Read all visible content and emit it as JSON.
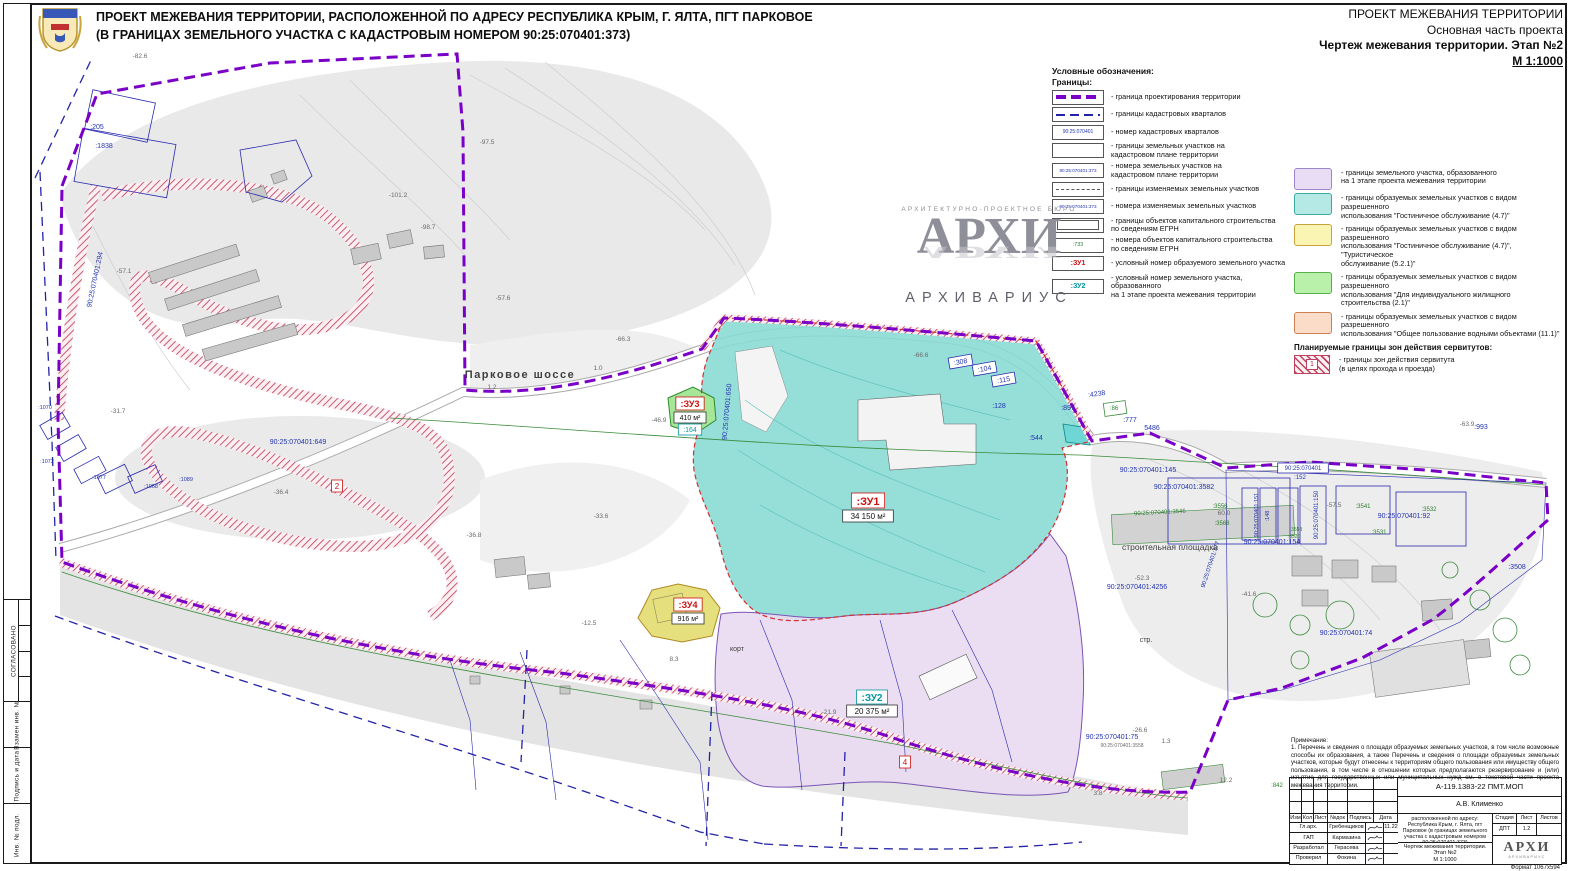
{
  "header_left": {
    "line1": "ПРОЕКТ МЕЖЕВАНИЯ ТЕРРИТОРИИ, РАСПОЛОЖЕННОЙ ПО АДРЕСУ РЕСПУБЛИКА КРЫМ, Г. ЯЛТА, ПГТ ПАРКОВОЕ",
    "line2": "(В ГРАНИЦАХ ЗЕМЕЛЬНОГО УЧАСТКА С КАДАСТРОВЫМ НОМЕРОМ 90:25:070401:373)"
  },
  "header_right": {
    "line1": "ПРОЕКТ МЕЖЕВАНИЯ ТЕРРИТОРИИ",
    "line2": "Основная часть проекта",
    "line3": "Чертеж межевания территории. Этап №2",
    "line4": "М 1:1000"
  },
  "side_strip": {
    "labels": [
      "СОГЛАСОВАНО",
      "Взамен инв. №",
      "Подпись и дата",
      "Инв. № подл."
    ]
  },
  "legend": {
    "title": "Условные обозначения:",
    "subtitle": "Границы:",
    "line_items": [
      {
        "type": "pdash",
        "label": "- граница проектирования территории"
      },
      {
        "type": "bdash",
        "label": "- границы кадастровых кварталов"
      },
      {
        "type": "txt",
        "text": "90:25:070401",
        "color": "#2233b0",
        "fs": 5,
        "label": "- номер кадастровых кварталов"
      },
      {
        "type": "empty",
        "label": "- границы земельных участков на\nкадастровом плане территории"
      },
      {
        "type": "txt",
        "text": "90:25:070401:373",
        "color": "#2233b0",
        "fs": 4.6,
        "label": "- номера земельных участков на\nкадастровом плане территории"
      },
      {
        "type": "gdash",
        "label": "- границы изменяемых земельных  участков"
      },
      {
        "type": "txt",
        "text": "90:25:070401:373",
        "color": "#2233b0",
        "fs": 4.6,
        "label": "- номера изменяемых земельных участков"
      },
      {
        "type": "drect",
        "label": "- границы объектов капитального строительства\nпо сведениям ЕГРН"
      },
      {
        "type": "txt",
        "text": ":733",
        "color": "#2e7d32",
        "fs": 5.5,
        "label": "- номера объектов капитального строительства\nпо сведениям ЕГРН"
      },
      {
        "type": "txt",
        "text": ":ЗУ1",
        "color": "#cc1111",
        "fs": 7,
        "bold": true,
        "label": "- условный номер образуемого земельного участка"
      },
      {
        "type": "txt",
        "text": ":ЗУ2",
        "color": "#00979e",
        "fs": 7,
        "bold": true,
        "label": "- условный номер земельного участка, образованного\nна 1 этапе проекта межевания территории"
      }
    ],
    "area_items": [
      {
        "fill": "#e9ddf6",
        "border": "#9a86c8",
        "label": "- границы земельного участка, образованного\nна 1 этапе проекта межевания территории"
      },
      {
        "fill": "#b5e9e5",
        "border": "#3aa9a4",
        "label": "- границы образуемых земельных участков с видом разрешенного\nиспользования \"Гостиничное обслуживание (4.7)\""
      },
      {
        "fill": "#faf5b2",
        "border": "#c9a43a",
        "label": "- границы образуемых земельных участков с видом разрешенного\nиспользования \"Гостиничное обслуживание (4.7)\", \"Туристическое\nобслуживание (5.2.1)\""
      },
      {
        "fill": "#b9f0aa",
        "border": "#57b04a",
        "label": "- границы образуемых земельных участков с видом разрешенного\nиспользования \"Для индивидуального жилищного строительства (2.1)\""
      },
      {
        "fill": "#fbdcc8",
        "border": "#cf8050",
        "label": "- границы образуемых земельных участков с видом разрешенного\nиспользования \"Общее пользование водными объектами (11.1)\""
      }
    ],
    "servitude": {
      "title": "Планируемые границы зон действия сервитутов:",
      "num": "1",
      "label": "- границы зон действия сервитута\n(в целях прохода и проезда)"
    }
  },
  "watermark": {
    "line1": "АРХИТЕКТУРНО-ПРОЕКТНОЕ БЮРО",
    "big": "АРХИ",
    "sub": "АРХИВАРИУС"
  },
  "map": {
    "labels": [
      {
        "x": 97,
        "y": 129,
        "t": ":205",
        "c": "blue"
      },
      {
        "x": 104,
        "y": 148,
        "t": ":1838",
        "c": "blue"
      },
      {
        "x": 298,
        "y": 444,
        "t": "90:25:070401:649",
        "c": "blue"
      },
      {
        "x": 961,
        "y": 364,
        "t": ":308",
        "c": "blue",
        "bx": "#2a2ab0",
        "r": -10
      },
      {
        "x": 985,
        "y": 371,
        "t": ":104",
        "c": "blue",
        "bx": "#2a2ab0",
        "r": -10
      },
      {
        "x": 1004,
        "y": 382,
        "t": ":115",
        "c": "blue",
        "bx": "#2a2ab0",
        "r": -10
      },
      {
        "x": 999,
        "y": 408,
        "t": ":128",
        "c": "blue"
      },
      {
        "x": 1068,
        "y": 410,
        "t": ":897",
        "c": "blue"
      },
      {
        "x": 1097,
        "y": 396,
        "t": ":4238",
        "c": "blue",
        "r": -8
      },
      {
        "x": 1130,
        "y": 422,
        "t": ":777",
        "c": "blue"
      },
      {
        "x": 1152,
        "y": 430,
        "t": "5486",
        "c": "blue"
      },
      {
        "x": 1036,
        "y": 440,
        "t": ":544",
        "c": "blue"
      },
      {
        "x": 1481,
        "y": 429,
        "t": ":993",
        "c": "blue"
      },
      {
        "x": 1137,
        "y": 589,
        "t": "90:25:070401:4256",
        "c": "blue"
      },
      {
        "x": 1112,
        "y": 739,
        "t": "90:25:070401:75",
        "c": "blue"
      },
      {
        "x": 1148,
        "y": 472,
        "t": "90:25:070401:145",
        "c": "blue"
      },
      {
        "x": 1184,
        "y": 489,
        "t": "90:25:070401:3582",
        "c": "blue"
      },
      {
        "x": 1404,
        "y": 518,
        "t": "90:25:070401:92",
        "c": "blue"
      },
      {
        "x": 1272,
        "y": 544,
        "t": "90:25:070401:154",
        "c": "blue"
      },
      {
        "x": 1346,
        "y": 635,
        "t": "90:25:070401:74",
        "c": "blue"
      },
      {
        "x": 1517,
        "y": 569,
        "t": ":3508",
        "c": "blue"
      },
      {
        "x": 45,
        "y": 409,
        "t": ":1070",
        "c": "blue",
        "fs": 5.5
      },
      {
        "x": 47,
        "y": 463,
        "t": ":1072",
        "c": "blue",
        "fs": 5.5
      },
      {
        "x": 99,
        "y": 479,
        "t": ":1077",
        "c": "blue",
        "fs": 5.5
      },
      {
        "x": 151,
        "y": 488,
        "t": ":1068",
        "c": "blue",
        "fs": 5.5
      },
      {
        "x": 186,
        "y": 481,
        "t": ":1089",
        "c": "blue",
        "fs": 5.5
      },
      {
        "x": 1303,
        "y": 470,
        "t": "90:25:070401",
        "c": "blue",
        "fs": 6,
        "bx": "#2a2ab0"
      },
      {
        "x": 1300,
        "y": 479,
        "t": ":152",
        "c": "blue",
        "fs": 6
      },
      {
        "x": 492,
        "y": 389,
        "t": "1.2",
        "c": "gray"
      },
      {
        "x": 598,
        "y": 370,
        "t": "1.0",
        "c": "gray"
      },
      {
        "x": 1166,
        "y": 743,
        "t": "1.3",
        "c": "gray"
      },
      {
        "x": 1226,
        "y": 782,
        "t": "12.2",
        "c": "gray"
      },
      {
        "x": 97,
        "y": 280,
        "t": "90:25:070401:294",
        "c": "blue",
        "r": -78
      },
      {
        "x": 729,
        "y": 412,
        "t": "90:25:070401:650",
        "c": "blue",
        "r": -85
      },
      {
        "x": 1318,
        "y": 515,
        "t": "90:25:070401:150",
        "c": "blue",
        "r": -90,
        "fs": 6
      },
      {
        "x": 1258,
        "y": 515,
        "t": "90:25:070401:151",
        "c": "blue",
        "r": -90,
        "fs": 5.5
      },
      {
        "x": 1269,
        "y": 516,
        "t": ":148",
        "c": "blue",
        "r": -90,
        "fs": 5.5
      },
      {
        "x": 1212,
        "y": 565,
        "t": "90:25:070401:377",
        "c": "blue",
        "r": -72,
        "fs": 6
      },
      {
        "x": 1114,
        "y": 410,
        "t": ":86",
        "c": "green"
      },
      {
        "x": 1220,
        "y": 508,
        "t": ":3556",
        "c": "green"
      },
      {
        "x": 1222,
        "y": 525,
        "t": ":3568",
        "c": "green"
      },
      {
        "x": 1160,
        "y": 514,
        "t": "90:25:070401:3546",
        "c": "green",
        "r": -3
      },
      {
        "x": 1363,
        "y": 508,
        "t": ":3541",
        "c": "green"
      },
      {
        "x": 1379,
        "y": 534,
        "t": ":3531",
        "c": "green"
      },
      {
        "x": 1296,
        "y": 531,
        "t": ":3553",
        "c": "green",
        "fs": 5
      },
      {
        "x": 1294,
        "y": 538,
        "t": ":3526",
        "c": "green",
        "fs": 5
      },
      {
        "x": 1277,
        "y": 787,
        "t": ":842",
        "c": "green"
      },
      {
        "x": 1429,
        "y": 511,
        "t": ":3532",
        "c": "green"
      },
      {
        "x": 140,
        "y": 58,
        "t": "-82.6",
        "c": "gray"
      },
      {
        "x": 487,
        "y": 144,
        "t": "-97.5",
        "c": "gray"
      },
      {
        "x": 398,
        "y": 197,
        "t": "-101.2",
        "c": "gray"
      },
      {
        "x": 428,
        "y": 229,
        "t": "-98.7",
        "c": "gray"
      },
      {
        "x": 124,
        "y": 273,
        "t": "-57.1",
        "c": "gray"
      },
      {
        "x": 503,
        "y": 300,
        "t": "-57.6",
        "c": "gray"
      },
      {
        "x": 623,
        "y": 341,
        "t": "-66.3",
        "c": "gray"
      },
      {
        "x": 921,
        "y": 357,
        "t": "-66.6",
        "c": "gray"
      },
      {
        "x": 118,
        "y": 413,
        "t": "-31.7",
        "c": "gray"
      },
      {
        "x": 281,
        "y": 494,
        "t": "-36.4",
        "c": "gray"
      },
      {
        "x": 474,
        "y": 537,
        "t": "-36.8",
        "c": "gray"
      },
      {
        "x": 601,
        "y": 518,
        "t": "-33.6",
        "c": "gray"
      },
      {
        "x": 659,
        "y": 422,
        "t": "-46.9",
        "c": "gray"
      },
      {
        "x": 589,
        "y": 625,
        "t": "-12.5",
        "c": "gray"
      },
      {
        "x": 674,
        "y": 661,
        "t": "8.3",
        "c": "gray"
      },
      {
        "x": 829,
        "y": 714,
        "t": "-21.9",
        "c": "gray"
      },
      {
        "x": 1249,
        "y": 596,
        "t": "-41.6",
        "c": "gray"
      },
      {
        "x": 1467,
        "y": 426,
        "t": "-63.9",
        "c": "gray"
      },
      {
        "x": 1140,
        "y": 732,
        "t": "-26.6",
        "c": "gray"
      },
      {
        "x": 1334,
        "y": 507,
        "t": "-57.5",
        "c": "gray"
      },
      {
        "x": 1142,
        "y": 580,
        "t": "-52.3",
        "c": "gray"
      },
      {
        "x": 1224,
        "y": 515,
        "t": "60.0",
        "c": "gray"
      },
      {
        "x": 1122,
        "y": 747,
        "t": "90:25:070401:3558",
        "c": "gray",
        "fs": 5
      },
      {
        "x": 1098,
        "y": 795,
        "t": "3.8",
        "c": "gray"
      },
      {
        "x": 520,
        "y": 378,
        "t": "Парковое шоссе",
        "c": "name",
        "fs": 11,
        "ls": 1.5,
        "b": 1
      },
      {
        "x": 1170,
        "y": 550,
        "t": "строительная площадка",
        "c": "name"
      },
      {
        "x": 737,
        "y": 651,
        "t": "корт",
        "c": "name",
        "fs": 7
      },
      {
        "x": 1146,
        "y": 642,
        "t": "стр.",
        "c": "name",
        "fs": 7
      },
      {
        "x": 868,
        "y": 505,
        "t": ":ЗУ1",
        "c": "red",
        "fs": 11,
        "b": 1,
        "bx": "#cc1111"
      },
      {
        "x": 868,
        "y": 519,
        "t": "34 150 м²",
        "c": "black",
        "bx": "#333"
      },
      {
        "x": 690,
        "y": 407,
        "t": ":ЗУ3",
        "c": "red",
        "b": 1,
        "bx": "#cc1111"
      },
      {
        "x": 690,
        "y": 420,
        "t": "410 м²",
        "c": "black",
        "fs": 7,
        "bx": "#333"
      },
      {
        "x": 690,
        "y": 432,
        "t": ":164",
        "c": "teal",
        "fs": 7,
        "bx": "#00979e"
      },
      {
        "x": 688,
        "y": 608,
        "t": ":ЗУ4",
        "c": "red",
        "b": 1,
        "bx": "#cc1111"
      },
      {
        "x": 688,
        "y": 621,
        "t": "916 м²",
        "c": "black",
        "fs": 7,
        "bx": "#333"
      },
      {
        "x": 337,
        "y": 489,
        "t": "2",
        "c": "red",
        "fs": 8,
        "bx": "#cc1111"
      },
      {
        "x": 905,
        "y": 765,
        "t": "4",
        "c": "red",
        "fs": 8,
        "bx": "#cc1111"
      },
      {
        "x": 872,
        "y": 701,
        "t": ":ЗУ2",
        "c": "teal",
        "fs": 10,
        "b": 1,
        "bx": "#00979e"
      },
      {
        "x": 872,
        "y": 714,
        "t": "20 375 м²",
        "c": "black",
        "bx": "#333"
      }
    ]
  },
  "stamp": {
    "note_title": "Примечание:",
    "note": "1. Перечень и сведения о площади образуемых земельных участков, в том числе возможные способы их образования, а также Перечень и сведения о площади образуемых земельных участков, которые будут отнесены к территориям общего пользования или имуществу общего пользования, в том числе в отношении которых предполагаются резервирование и (или) изъятие для государственных или муниципальных нужд см. в текстовой части проекта межевания территории.",
    "doc_number": "А-119.1383-22 ПМТ.МОП",
    "author": "А.В. Клименко",
    "cols": [
      "Изм",
      "Кол",
      "Лист",
      "№док",
      "Подпись",
      "Дата"
    ],
    "rows": [
      {
        "role": "Гл.арх.",
        "name": "Гребенщиков",
        "date": "11.22"
      },
      {
        "role": "ГАП",
        "name": "Кармазина",
        "date": ""
      },
      {
        "role": "Разработал",
        "name": "Герасева",
        "date": ""
      },
      {
        "role": "Проверил",
        "name": "Фокина",
        "date": ""
      }
    ],
    "project": "Проект межевания территории, расположенной по адресу: Республика Крым, г. Ялта, пгт Парковое (в границах земельного участка с кадастровым номером 90:25:070401:373)",
    "drawing": "Чертеж межевания территории. Этап №2\nМ 1:1000",
    "stage_cols": [
      "Стадия",
      "Лист",
      "Листов"
    ],
    "stage": "ДПТ",
    "sheet": "1.2",
    "sheets": "",
    "logo": "АРХИ",
    "logo_sub": "АРХИВАРИУС",
    "format": "Формат 1067х594"
  }
}
